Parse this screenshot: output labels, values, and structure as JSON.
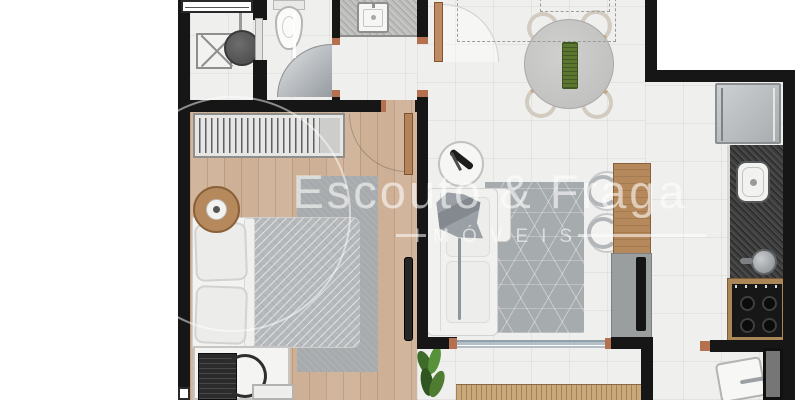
{
  "watermark": {
    "brand": "Escouto & Fraga",
    "subtitle": "IMÓVEIS"
  },
  "palette": {
    "wall": "#161616",
    "wood_floor": "#cdb095",
    "tile_floor": "#efefed",
    "copper_doorjamb": "#b5714f",
    "kitchen_granite": "#353535",
    "vanity_granite": "#b3b3b1",
    "rug_gray": "#a6abae",
    "furniture_wood": "#b5895c",
    "plant_green": "#4e7d32",
    "table_runner_green": "#5a762f"
  },
  "plan": {
    "type": "apartment-floor-plan",
    "rooms": [
      {
        "name": "laundry",
        "items": [
          "window",
          "washing-machine",
          "laundry-tank",
          "sliding-door"
        ]
      },
      {
        "name": "bathroom",
        "items": [
          "toilet",
          "glass-shower-door",
          "glass-partition"
        ]
      },
      {
        "name": "hall",
        "items": [
          "vanity-granite-counter",
          "washbasin",
          "door-to-living",
          "door-to-bedroom"
        ]
      },
      {
        "name": "bedroom",
        "items": [
          "wardrobe",
          "double-bed",
          "pillows",
          "rug",
          "round-side-table",
          "desk",
          "laptop",
          "desk-chair",
          "mirror",
          "window"
        ]
      },
      {
        "name": "living-dining",
        "items": [
          "sofa",
          "throw-blanket",
          "round-side-table",
          "patterned-rug",
          "dining-table",
          "dining-chairs-4",
          "office-chairs-2",
          "wood-sideboard",
          "tv-rack",
          "tv",
          "projection-dashed-lines"
        ]
      },
      {
        "name": "kitchen",
        "items": [
          "fridge",
          "granite-counter",
          "sink",
          "faucet",
          "cooktop-4-burners"
        ]
      },
      {
        "name": "balcony",
        "items": [
          "sliding-door-track",
          "plant",
          "wood-deck"
        ]
      },
      {
        "name": "entry",
        "items": [
          "entrance-door"
        ]
      }
    ]
  }
}
